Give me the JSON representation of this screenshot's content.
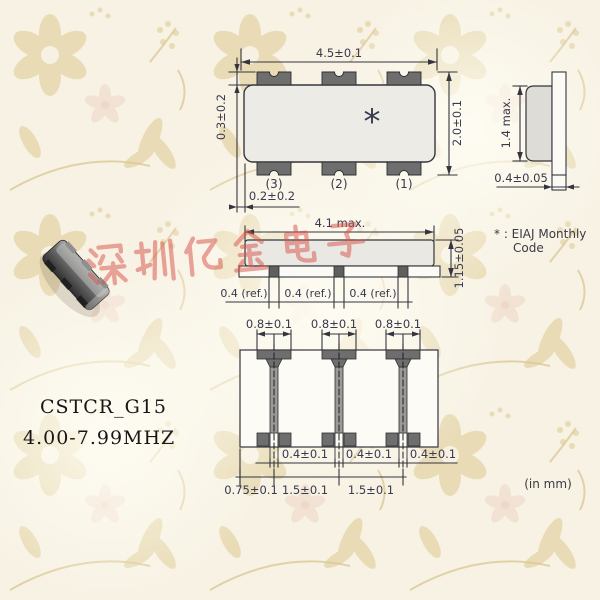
{
  "page": {
    "units_note": "(in mm)"
  },
  "product": {
    "series": "CSTCR_G15",
    "frequency_range": "4.00-7.99MHZ"
  },
  "watermark": {
    "text": "深圳亿金电子",
    "color": "#d85048"
  },
  "views": {
    "top": {
      "dim_width": "4.5±0.1",
      "dim_height": "2.0±0.1",
      "dim_terminal_top": "0.3±0.2",
      "dim_terminal_side": "0.2±0.2",
      "pin_labels": [
        "(3)",
        "(2)",
        "(1)"
      ],
      "marking_symbol": "*"
    },
    "end": {
      "dim_height": "1.4 max.",
      "dim_thickness": "0.4±0.05"
    },
    "front": {
      "dim_body_width": "4.1 max.",
      "dim_total_height": "1.15±0.05",
      "dim_terminals": [
        "0.4 (ref.)",
        "0.4 (ref.)",
        "0.4 (ref.)"
      ]
    },
    "bottom": {
      "dim_pad_widths": [
        "0.8±0.1",
        "0.8±0.1",
        "0.8±0.1"
      ],
      "dim_gaps": [
        "0.4±0.1",
        "0.4±0.1",
        "0.4±0.1"
      ],
      "dim_pitches": [
        "0.75±0.1",
        "1.5±0.1",
        "1.5±0.1"
      ]
    }
  },
  "footnote": {
    "line1": "* : EIAJ Monthly",
    "line2": "Code"
  },
  "colors": {
    "line": "#35353f",
    "pad_gray": "#6e6e6e",
    "body_gray": "#ecebe6",
    "wallpaper_base": "#f7f2e4",
    "wallpaper_motif": "#e5d6ab",
    "watermark_red": "#d85048"
  }
}
